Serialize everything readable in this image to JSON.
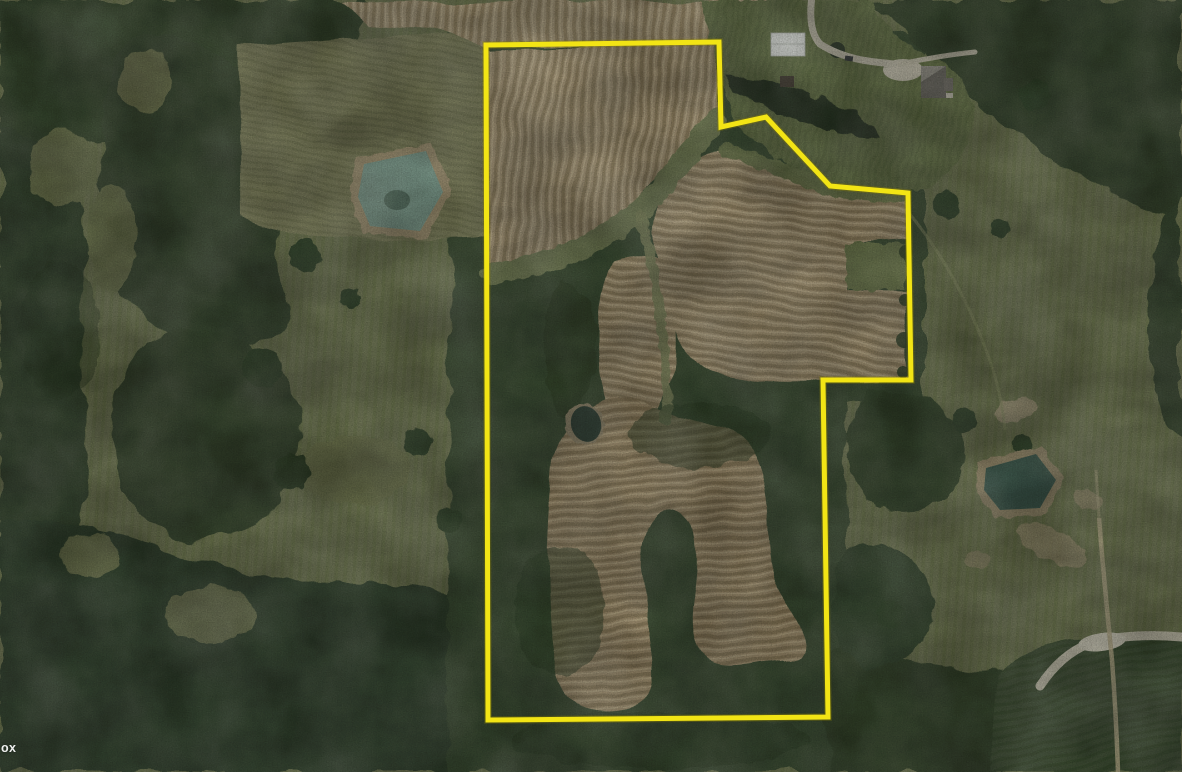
{
  "map": {
    "type": "satellite-imagery",
    "attribution": "ox",
    "boundary": {
      "stroke_color": "#f2e415",
      "under_stroke_color": "#8a7d00",
      "stroke_width": "5",
      "points": "486,45 719,42 721,127 766,117 830,186 908,193 911,380 823,380 828,717 488,720"
    },
    "visible_features": [
      "harvested crop fields with contour strips",
      "deciduous forest",
      "grass pastures",
      "farm pond west",
      "farm pond east",
      "small pond",
      "white barn",
      "farmhouse",
      "gravel driveway",
      "dirt road southeast",
      "farm trail"
    ]
  }
}
